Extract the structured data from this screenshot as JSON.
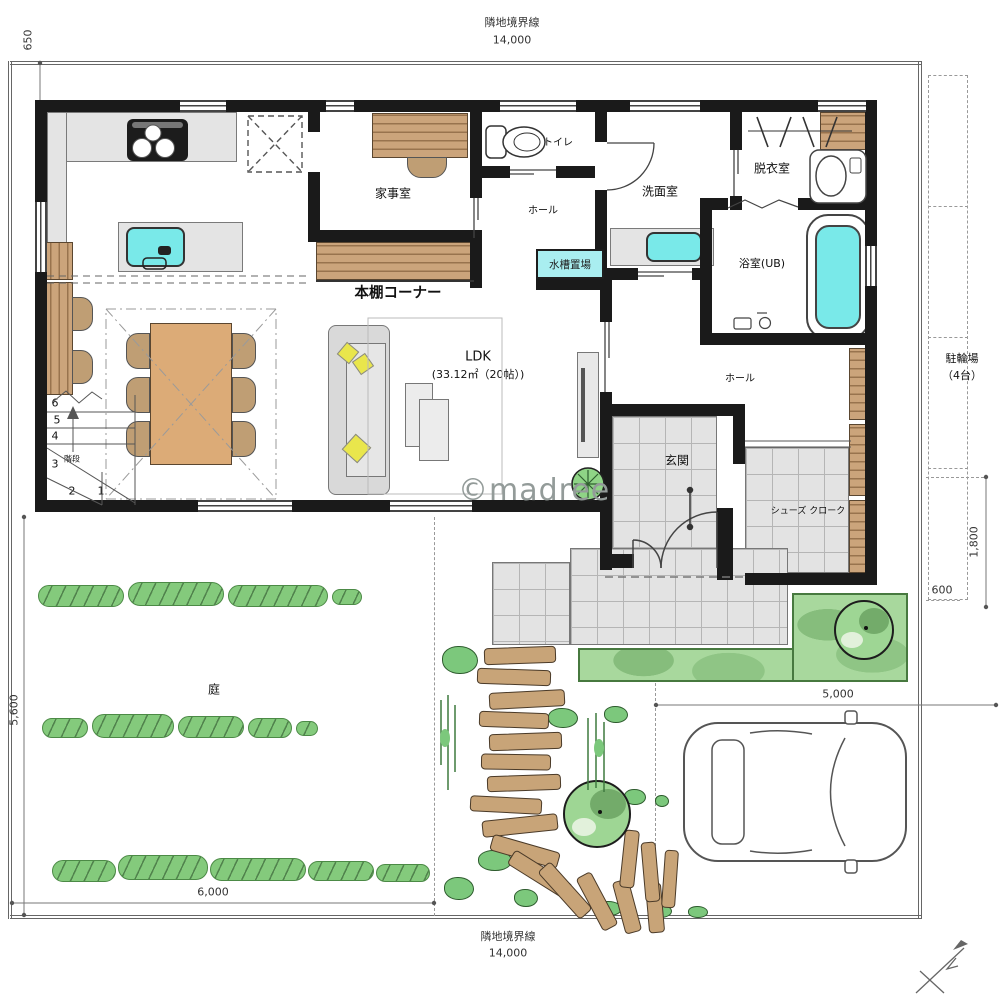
{
  "watermark": "©madree",
  "boundary": {
    "top": {
      "label": "隣地境界線",
      "dim": "14,000"
    },
    "bottom": {
      "label": "隣地境界線",
      "dim": "14,000"
    }
  },
  "dimensions": {
    "offset_top_left": "650",
    "garden_height": "5,600",
    "garden_width": "6,000",
    "parking_width": "5,000",
    "bike_height": "1,800",
    "bike_width": "600"
  },
  "rooms": {
    "kajishitsu": "家事室",
    "toilet": "トイレ",
    "hall_upper": "ホール",
    "senmenshitsu": "洗面室",
    "datsuishitsu": "脱衣室",
    "bathroom": "浴室(UB)",
    "suiso_okiba": "水槽置場",
    "hondana_corner": "本棚コーナー",
    "ldk": "LDK",
    "ldk_area": "(33.12㎡（20帖）)",
    "hall_lower": "ホール",
    "genkan": "玄関",
    "shoes_cloak": "シューズ クローク",
    "kaidan": "階段",
    "garden": "庭",
    "parking": "駐車場",
    "bike_parking": "駐輪場",
    "bike_capacity": "（4台）"
  },
  "stairs": {
    "steps": [
      "1",
      "2",
      "3",
      "4",
      "5",
      "6"
    ]
  }
}
